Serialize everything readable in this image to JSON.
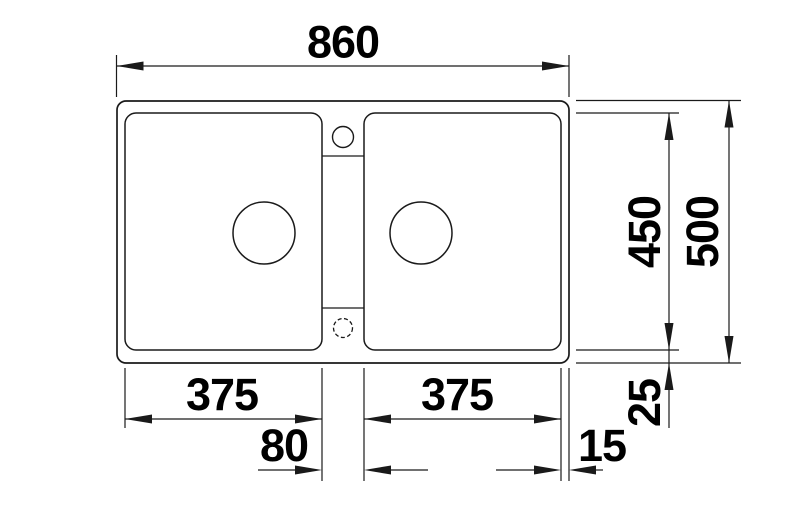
{
  "drawing": {
    "kind": "double-bowl sink plan view, dimensioned technical drawing",
    "units": "mm"
  },
  "dims": {
    "overall_width": "860",
    "overall_depth": "500",
    "bowl_depth": "450",
    "left_bowl_width": "375",
    "right_bowl_width": "375",
    "divider_width": "80",
    "right_rim": "15",
    "bottom_rim": "25"
  },
  "colors": {
    "line": "#1a1a1a",
    "text": "#000000",
    "background": "#ffffff"
  }
}
